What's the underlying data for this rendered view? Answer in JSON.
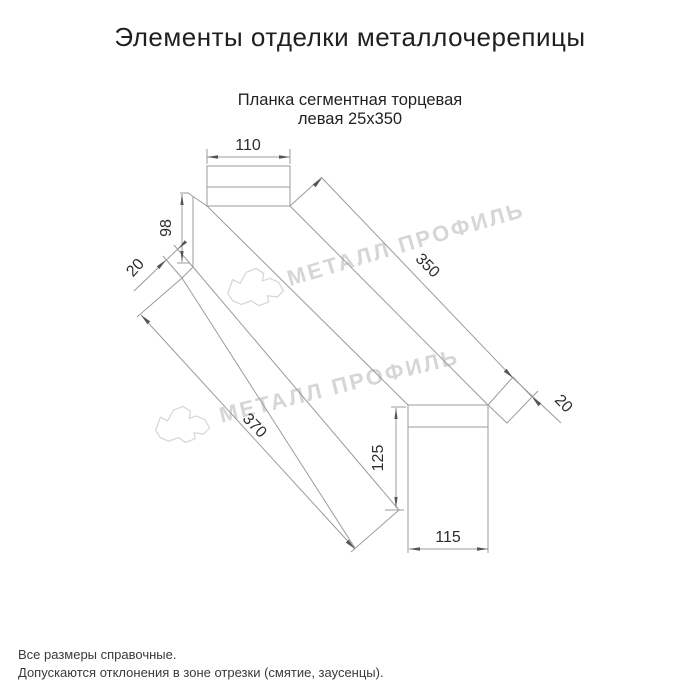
{
  "page": {
    "title": "Элементы отделки металлочерепицы",
    "subtitle_line1": "Планка сегментная торцевая",
    "subtitle_line2": "левая 25х350"
  },
  "drawing": {
    "dimensions": {
      "top_flange_width": "110",
      "left_height": "98",
      "left_hem": "20",
      "top_length": "350",
      "right_flap": "20",
      "bottom_length": "370",
      "right_height": "125",
      "bottom_flange_width": "115"
    },
    "watermark_text": "МЕТАЛЛ ПРОФИЛЬ",
    "colors": {
      "line": "#9b9b9b",
      "arrow": "#555555",
      "dim_text": "#2e2e2e",
      "watermark": "#d6d6d6"
    }
  },
  "footer": {
    "note1": "Все размеры справочные.",
    "note2": "Допускаются отклонения в зоне отрезки (смятие, заусенцы)."
  }
}
